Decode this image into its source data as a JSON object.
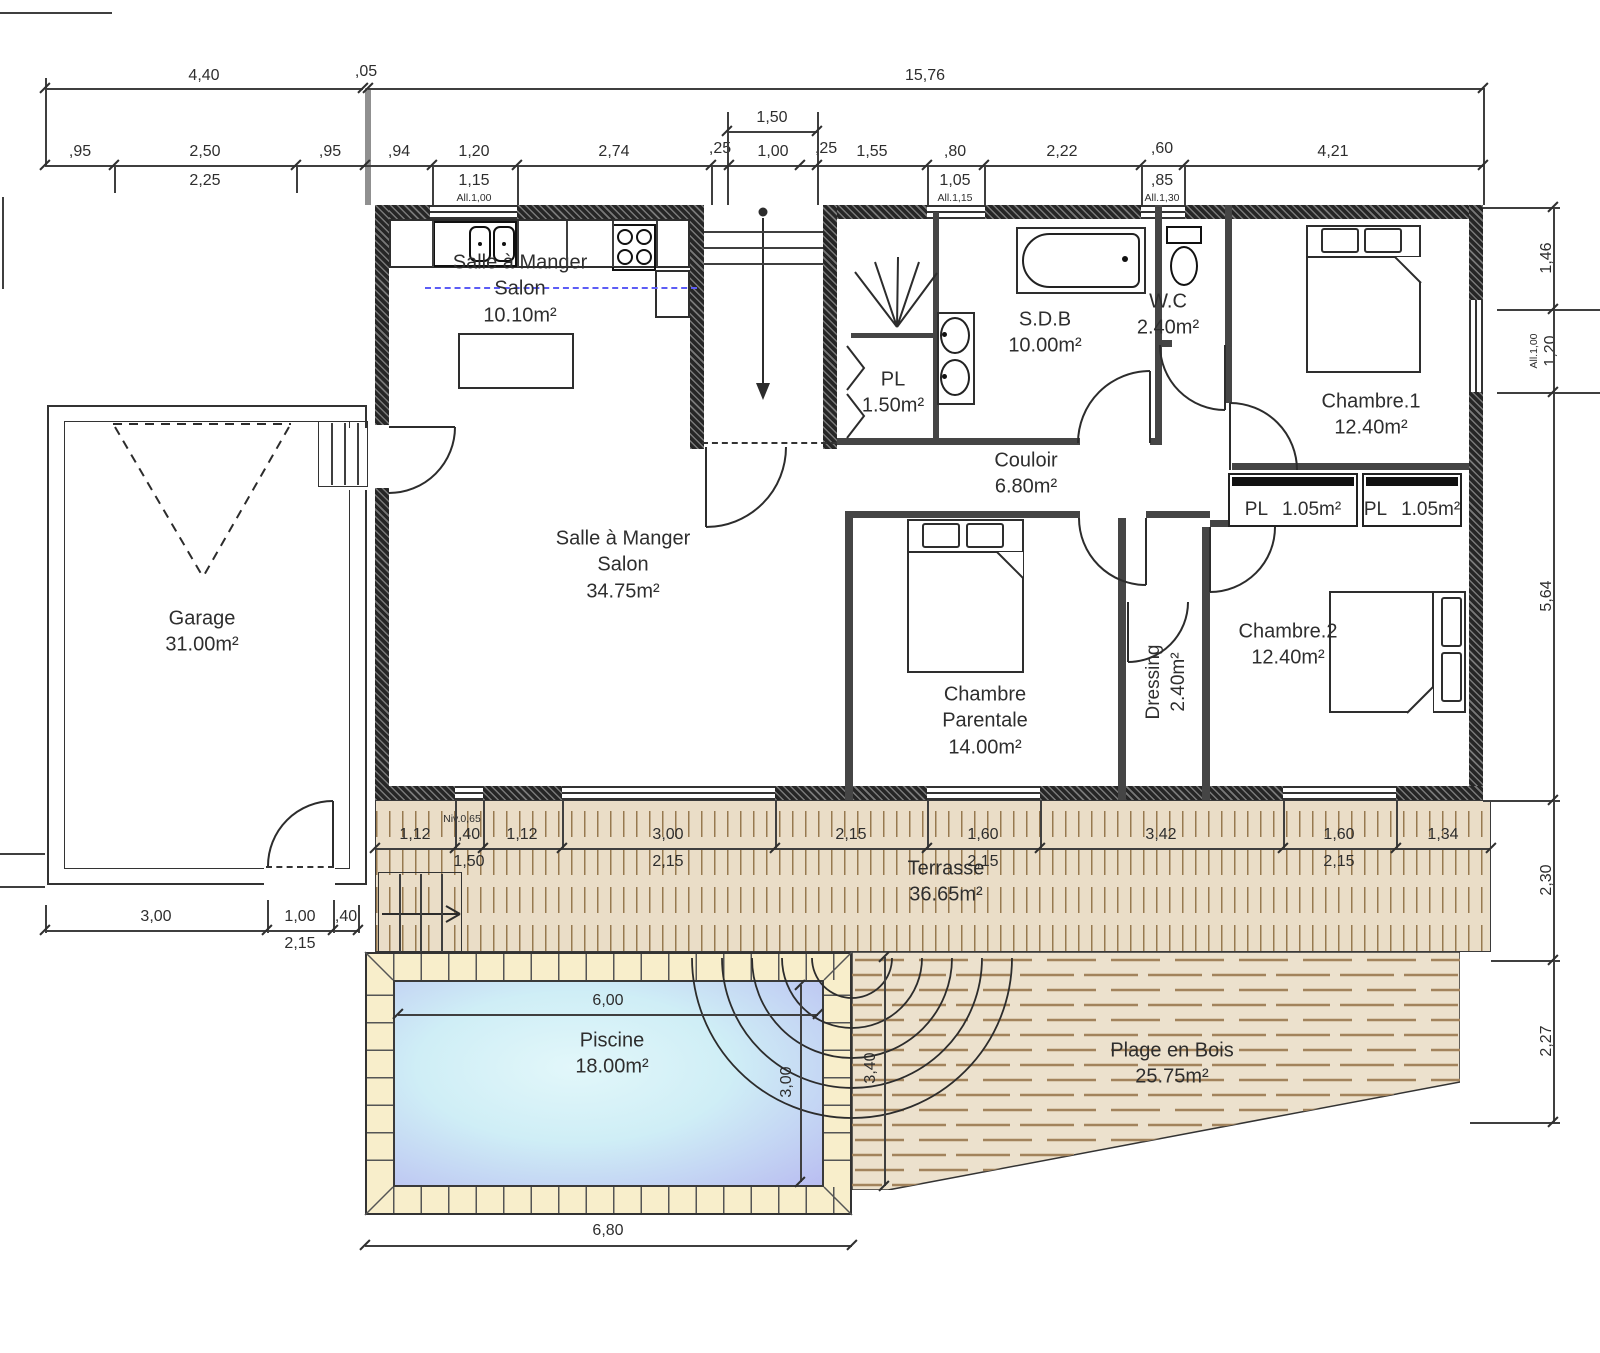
{
  "colors": {
    "wall": "#262626",
    "terrace_wood": "#eaddc7",
    "plank_line": "#97794f",
    "plage_wood": "#ece1cd",
    "pool_tile": "#f8eecb",
    "water_center": "#e2f7fa",
    "water_edge": "#b9bdf1",
    "zone_line_blue": "#5c5cf5"
  },
  "rooms": {
    "salon_small": {
      "l1": "Salle à Manger",
      "l2": "Salon",
      "area": "10.10m²"
    },
    "salon_main": {
      "l1": "Salle à Manger",
      "l2": "Salon",
      "area": "34.75m²"
    },
    "garage": {
      "l1": "Garage",
      "area": "31.00m²"
    },
    "sdb": {
      "l1": "S.D.B",
      "area": "10.00m²"
    },
    "wc": {
      "l1": "W.C",
      "area": "2.40m²"
    },
    "pl_bain": {
      "l1": "PL",
      "area": "1.50m²"
    },
    "couloir": {
      "l1": "Couloir",
      "area": "6.80m²"
    },
    "chambre1": {
      "l1": "Chambre.1",
      "area": "12.40m²"
    },
    "pl1": {
      "l1": "PL",
      "area": "1.05m²"
    },
    "pl2": {
      "l1": "PL",
      "area": "1.05m²"
    },
    "parentale": {
      "l1": "Chambre",
      "l2": "Parentale",
      "area": "14.00m²"
    },
    "dressing": {
      "l1": "Dressing",
      "area": "2.40m²"
    },
    "chambre2": {
      "l1": "Chambre.2",
      "area": "12.40m²"
    },
    "terrasse": {
      "l1": "Terrasse",
      "area": "36.65m²"
    },
    "piscine": {
      "l1": "Piscine",
      "area": "18.00m²"
    },
    "plage": {
      "l1": "Plage en Bois",
      "area": "25.75m²"
    }
  },
  "dims": {
    "overall": [
      "4,40",
      ",05",
      "15,76"
    ],
    "bracket": "1,50",
    "row": [
      ",95",
      "2,50",
      ",95",
      ",94",
      "1,20",
      "2,74",
      ",25",
      "1,00",
      ",25",
      "1,55",
      ",80",
      "2,22",
      ",60",
      "4,21"
    ],
    "row_sub": [
      "2,25",
      "1,15",
      "All.1,00",
      "1,05",
      "All.1,15",
      ",85",
      "All.1,30"
    ],
    "right": [
      "1,46",
      "1,20",
      "All.1,00",
      "5,64",
      "2,30",
      "2,27"
    ],
    "terrace": [
      "1,12",
      ",40",
      "1,12",
      "3,00",
      "2,15",
      "1,60",
      "3,42",
      "1,60",
      "1,34"
    ],
    "terrace_sub": [
      "Niv.0,65",
      "1,50",
      "2,15",
      "2,15",
      "2,15"
    ],
    "garage_row": [
      "3,00",
      "1,00",
      "2,15",
      ",40"
    ],
    "pool": [
      "6,00",
      "3,00",
      "3,40",
      "6,80"
    ]
  }
}
